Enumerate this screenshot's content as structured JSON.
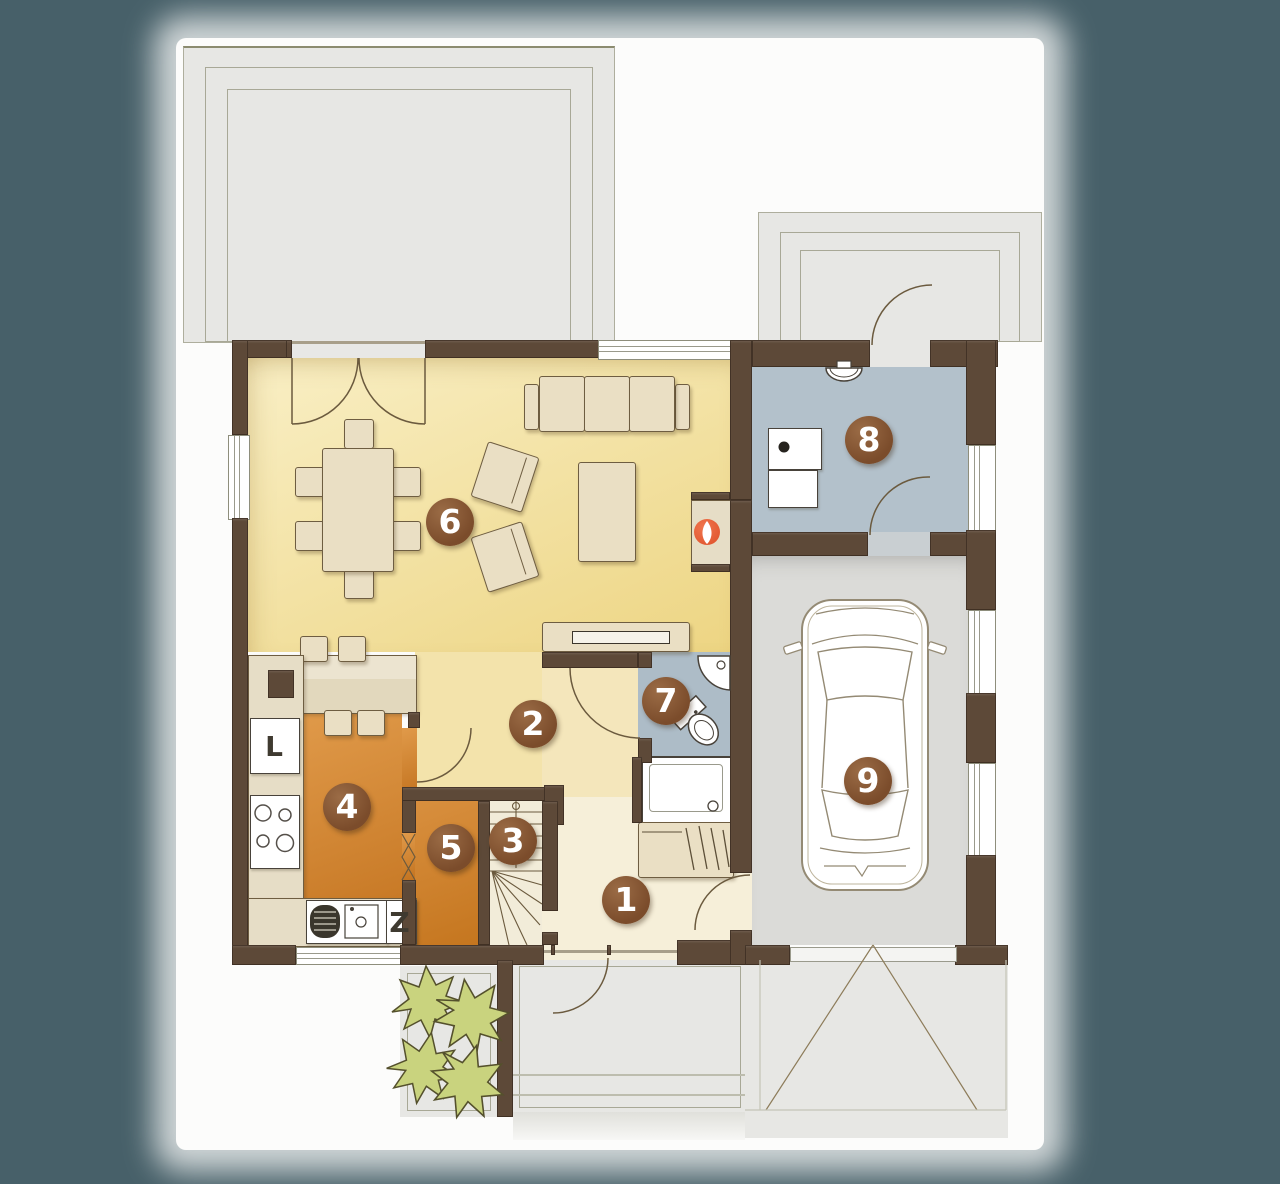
{
  "canvas": {
    "width": 1280,
    "height": 1184
  },
  "background_color": "#476069",
  "rooms": [
    {
      "label": "1"
    },
    {
      "label": "2"
    },
    {
      "label": "3"
    },
    {
      "label": "4"
    },
    {
      "label": "5"
    },
    {
      "label": "6"
    },
    {
      "label": "7"
    },
    {
      "label": "8"
    },
    {
      "label": "9"
    }
  ],
  "labels": {
    "fridge": "L",
    "dishwasher": "Z"
  },
  "colors": {
    "wall": "#5d4938",
    "living_floor": "#f2df9f",
    "kitchen_floor": "#d2832f",
    "pantry_floor": "#cd8634",
    "bathroom_floor": "#adbcc7",
    "utility_floor": "#b3c1cb",
    "garage_floor": "#dbdbd8",
    "hall_floor": "#f3e3ab",
    "entry_floor": "#f6efd9",
    "badge": "#80512e",
    "fireplace": "#e8613c",
    "shrub": "#c9d37e",
    "paving": "#e7e7e4"
  }
}
